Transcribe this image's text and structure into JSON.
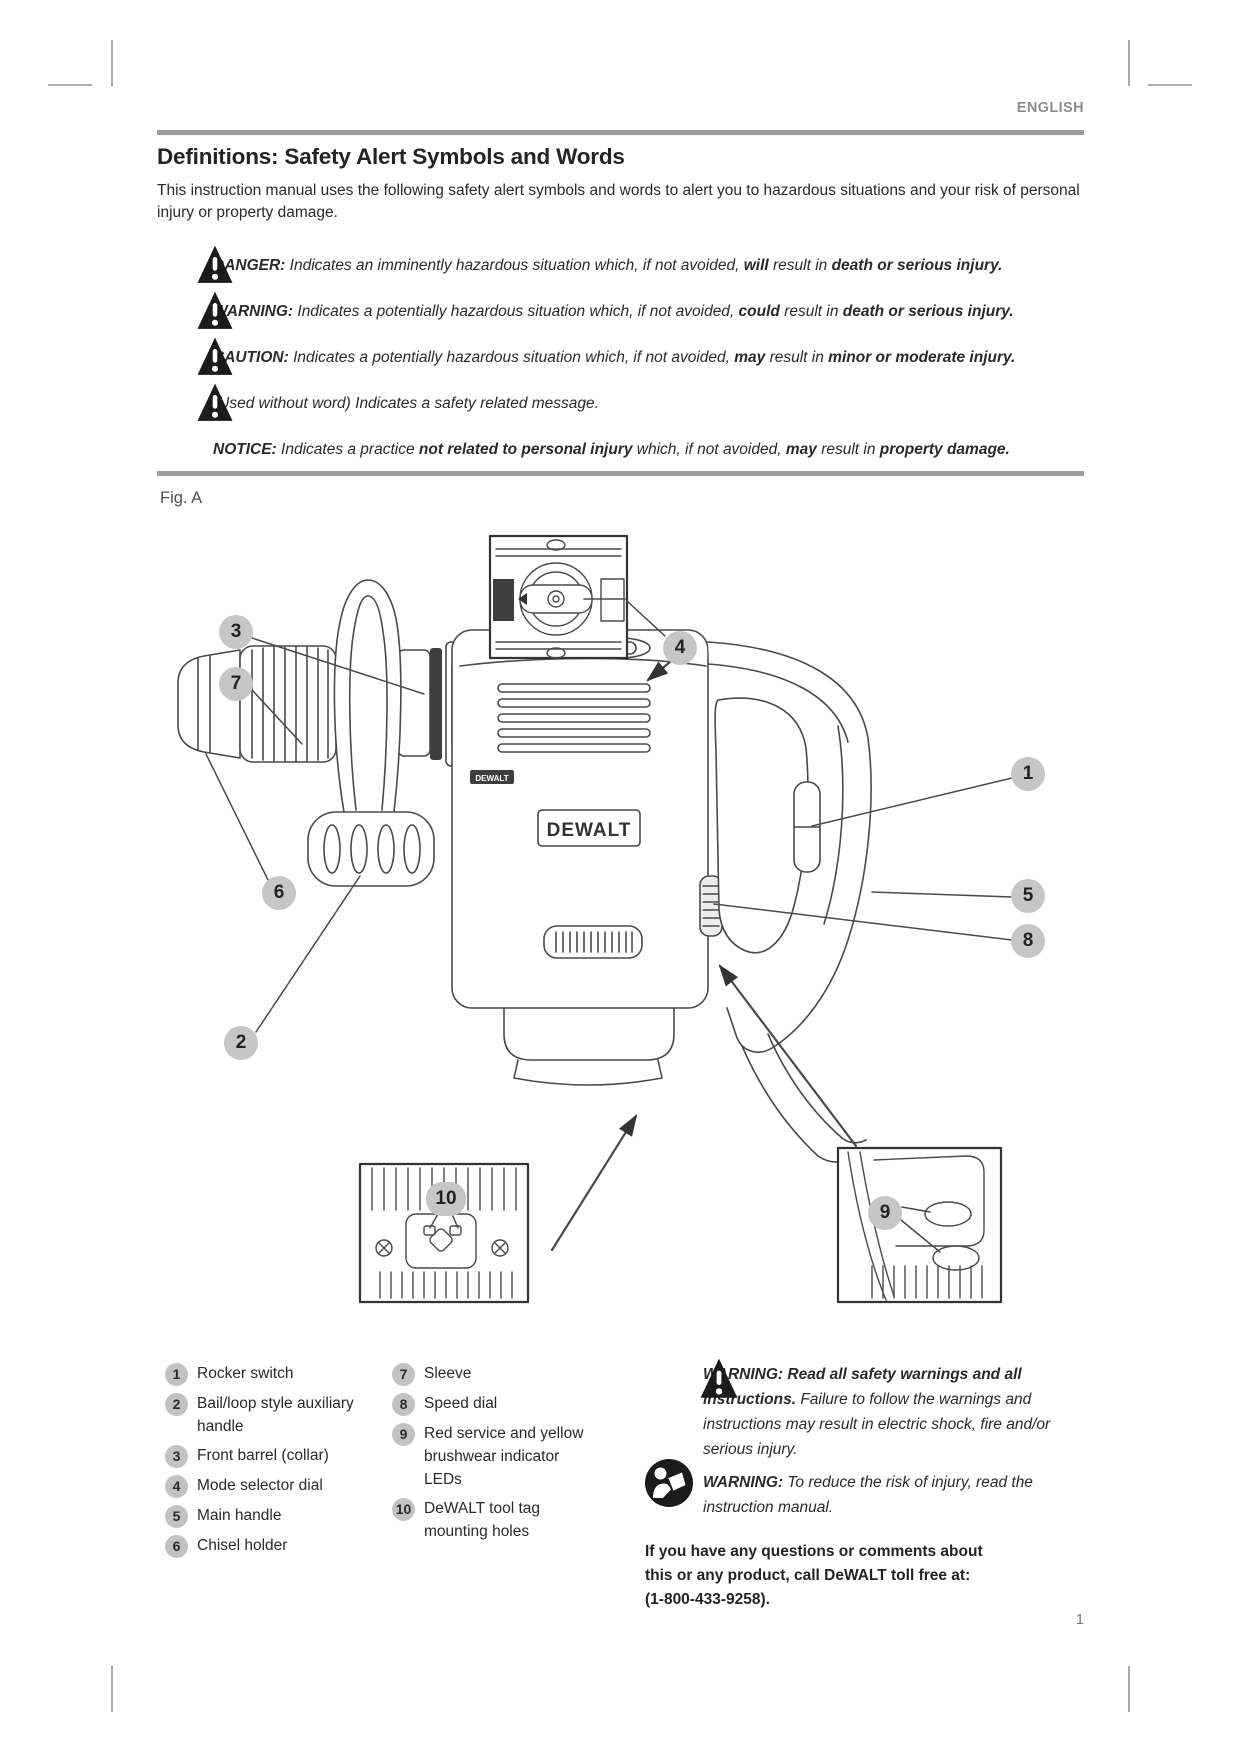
{
  "page": {
    "language": "ENGLISH",
    "number": "1",
    "figure_label": "Fig. A"
  },
  "section": {
    "title": "Definitions: Safety Alert Symbols and Words",
    "intro": "This instruction manual uses the following safety alert symbols and words to alert you to hazardous situations and your risk of personal injury or property damage."
  },
  "definitions": [
    {
      "segments": [
        {
          "t": "DANGER:",
          "s": "bi"
        },
        {
          "t": " Indicates an imminently hazardous situation which, if not avoided, ",
          "s": "i"
        },
        {
          "t": "will",
          "s": "bi"
        },
        {
          "t": " result in ",
          "s": "i"
        },
        {
          "t": "death or serious injury.",
          "s": "bi"
        }
      ]
    },
    {
      "segments": [
        {
          "t": "WARNING:",
          "s": "bi"
        },
        {
          "t": " Indicates a potentially hazardous situation which, if not avoided, ",
          "s": "i"
        },
        {
          "t": "could",
          "s": "bi"
        },
        {
          "t": " result in ",
          "s": "i"
        },
        {
          "t": "death or serious injury.",
          "s": "bi"
        }
      ]
    },
    {
      "segments": [
        {
          "t": "CAUTION:",
          "s": "bi"
        },
        {
          "t": " Indicates a potentially hazardous situation which, if not avoided, ",
          "s": "i"
        },
        {
          "t": "may",
          "s": "bi"
        },
        {
          "t": " result in ",
          "s": "i"
        },
        {
          "t": "minor or moderate injury.",
          "s": "bi"
        }
      ]
    },
    {
      "segments": [
        {
          "t": "(Used without word) Indicates a safety related message.",
          "s": "i"
        }
      ]
    },
    {
      "segments": [
        {
          "t": "NOTICE:",
          "s": "bi"
        },
        {
          "t": " Indicates a practice ",
          "s": "i"
        },
        {
          "t": "not related to personal injury",
          "s": "bi"
        },
        {
          "t": " which, if not avoided, ",
          "s": "i"
        },
        {
          "t": "may",
          "s": "bi"
        },
        {
          "t": " result in ",
          "s": "i"
        },
        {
          "t": "property damage.",
          "s": "bi"
        }
      ]
    }
  ],
  "figure": {
    "logo": "DEWALT",
    "callouts": [
      "3",
      "7",
      "4",
      "1",
      "6",
      "5",
      "8",
      "2",
      "10",
      "9"
    ]
  },
  "legend": [
    {
      "n": "1",
      "label": "Rocker switch"
    },
    {
      "n": "2",
      "label": "Bail/loop style auxiliary handle"
    },
    {
      "n": "3",
      "label": "Front barrel (collar)"
    },
    {
      "n": "4",
      "label": "Mode selector dial"
    },
    {
      "n": "5",
      "label": "Main handle"
    },
    {
      "n": "6",
      "label": "Chisel holder"
    },
    {
      "n": "7",
      "label": "Sleeve"
    },
    {
      "n": "8",
      "label": "Speed dial"
    },
    {
      "n": "9",
      "label": "Red service and yellow brushwear indicator LEDs"
    },
    {
      "n": "10",
      "label": "DeWALT tool tag mounting holes"
    }
  ],
  "warnings": {
    "w1": {
      "segments": [
        {
          "t": "WARNING: Read all safety warnings and all instructions.",
          "s": "bi"
        },
        {
          "t": " Failure to follow the warnings and instructions may result in electric shock, fire and/or serious injury.",
          "s": "i"
        }
      ]
    },
    "w2": {
      "segments": [
        {
          "t": "WARNING:",
          "s": "bi"
        },
        {
          "t": " To reduce the risk of injury, read the instruction manual.",
          "s": "i"
        }
      ]
    },
    "contact_lines": [
      "If you have any questions or comments about",
      "this or any product, call DeWALT toll free at:",
      "(1-800-433-9258)."
    ]
  }
}
